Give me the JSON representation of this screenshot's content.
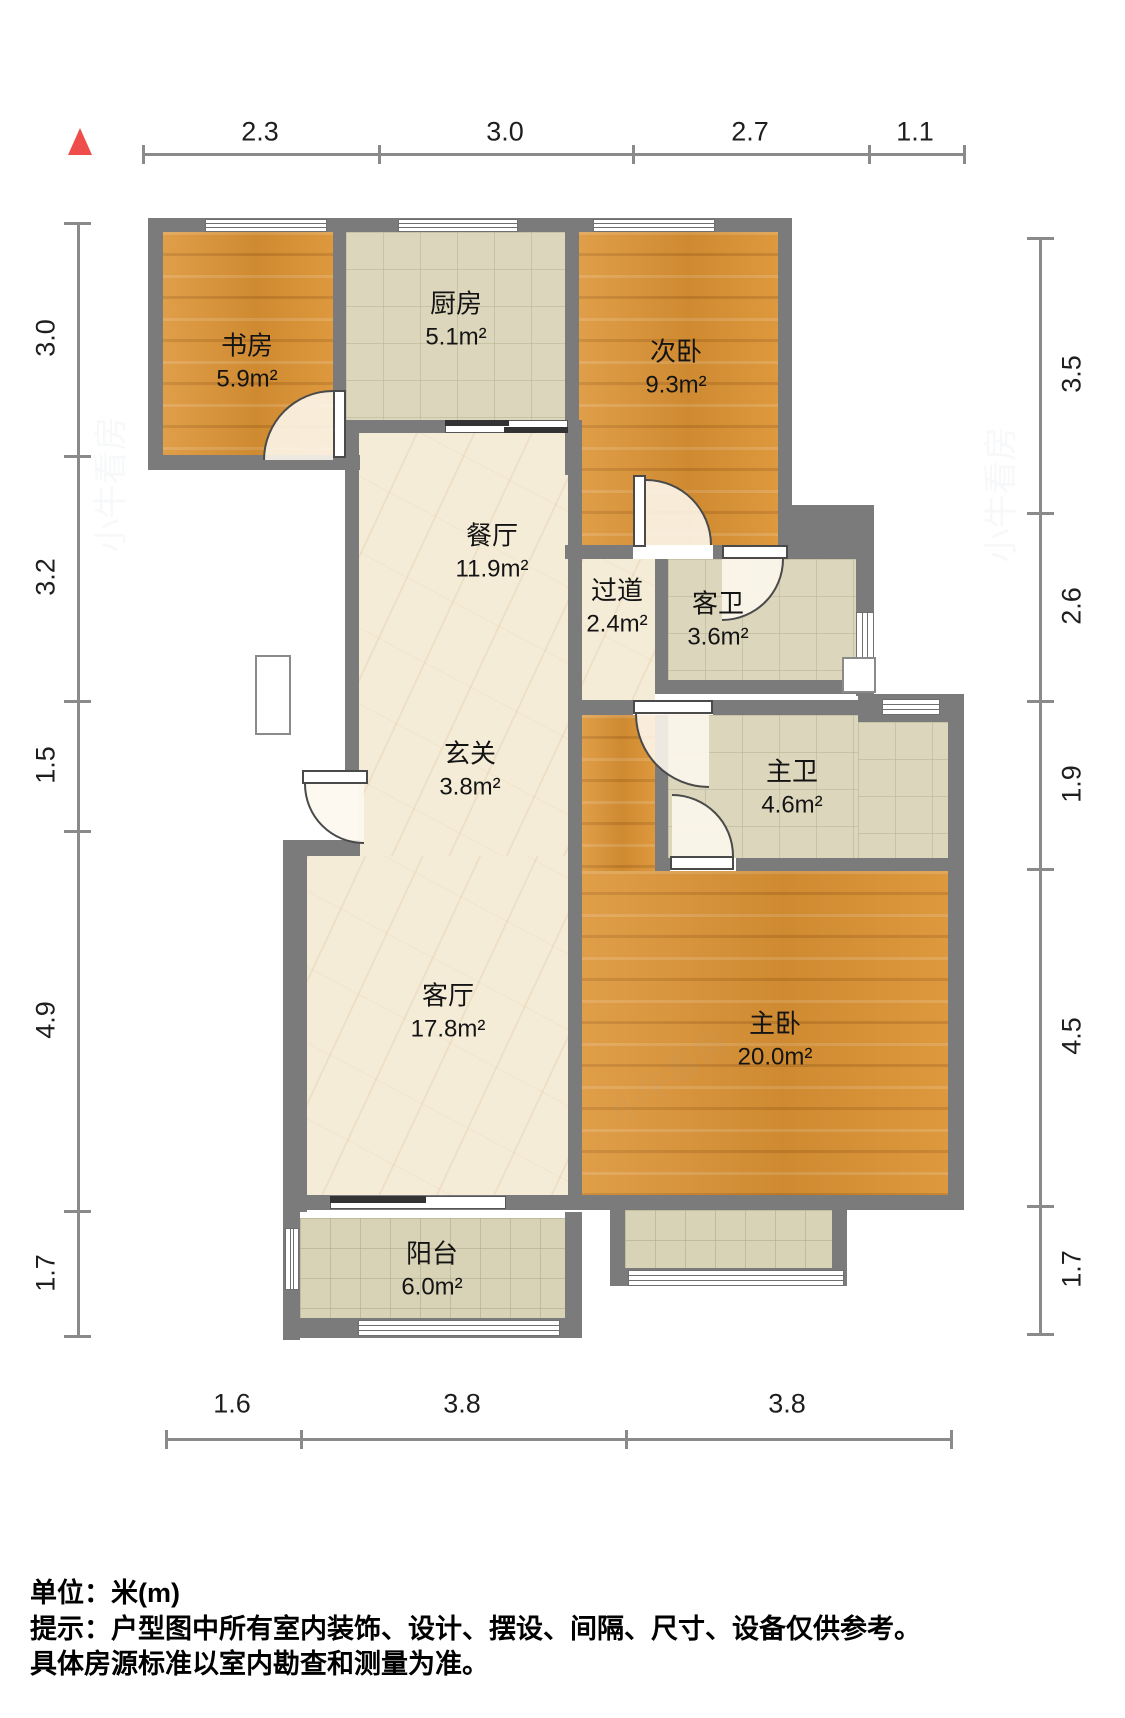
{
  "plan_title": "户型图",
  "north_indicator": "north",
  "dims": {
    "top": [
      "2.3",
      "3.0",
      "2.7",
      "1.1"
    ],
    "left": [
      "3.0",
      "3.2",
      "1.5",
      "4.9",
      "1.7"
    ],
    "right": [
      "3.5",
      "2.6",
      "1.9",
      "4.5",
      "1.7"
    ],
    "bottom": [
      "1.6",
      "3.8",
      "3.8"
    ]
  },
  "rooms": {
    "study": {
      "name": "书房",
      "area": "5.9m²"
    },
    "kitchen": {
      "name": "厨房",
      "area": "5.1m²"
    },
    "bedroom2": {
      "name": "次卧",
      "area": "9.3m²"
    },
    "dining": {
      "name": "餐厅",
      "area": "11.9m²"
    },
    "hallway": {
      "name": "过道",
      "area": "2.4m²"
    },
    "guest_bath": {
      "name": "客卫",
      "area": "3.6m²"
    },
    "entry": {
      "name": "玄关",
      "area": "3.8m²"
    },
    "master_bath": {
      "name": "主卫",
      "area": "4.6m²"
    },
    "living": {
      "name": "客厅",
      "area": "17.8m²"
    },
    "master_bedroom": {
      "name": "主卧",
      "area": "20.0m²"
    },
    "balcony": {
      "name": "阳台",
      "area": "6.0m²"
    }
  },
  "footer": {
    "line1": "单位：米(m)",
    "line2": "提示：户型图中所有室内装饰、设计、摆设、间隔、尺寸、设备仅供参考。",
    "line3": "具体房源标准以室内勘查和测量为准。"
  },
  "watermark": "小牛看房",
  "colors": {
    "wall": "#7b7b7b",
    "wood_floor": "#dc9334",
    "marble_floor": "#f5ecd8",
    "tile_floor": "#dcd6bd",
    "north_red": "#ef4c4c"
  }
}
